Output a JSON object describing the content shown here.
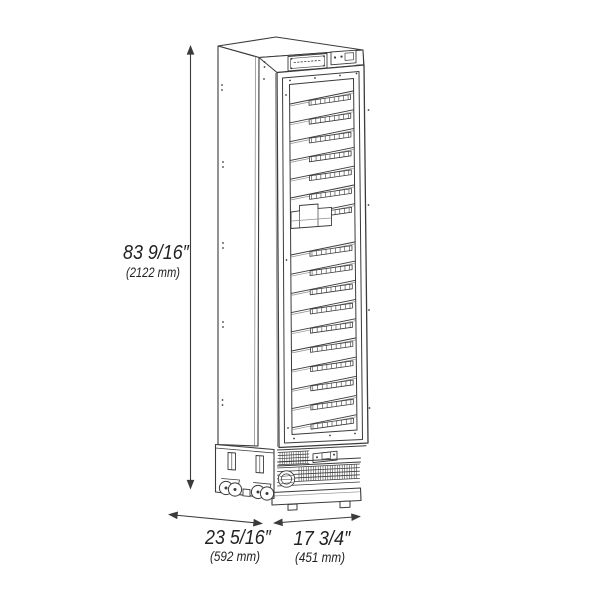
{
  "diagram": {
    "subject": "tall-single-door-glass-wine-cooler-line-drawing",
    "style": {
      "line_color": "#3b3b3b",
      "light_line_color": "#8f8f8f",
      "text_color": "#222222",
      "background": "#ffffff"
    },
    "dimensions": {
      "height": {
        "imperial": "83 9/16″",
        "metric": "(2122 mm)"
      },
      "depth": {
        "imperial": "23 5/16″",
        "metric": "(592 mm)"
      },
      "width": {
        "imperial": "17 3/4″",
        "metric": "(451 mm)"
      }
    },
    "shelves": {
      "upper_count": 7,
      "lower_count": 10
    }
  }
}
